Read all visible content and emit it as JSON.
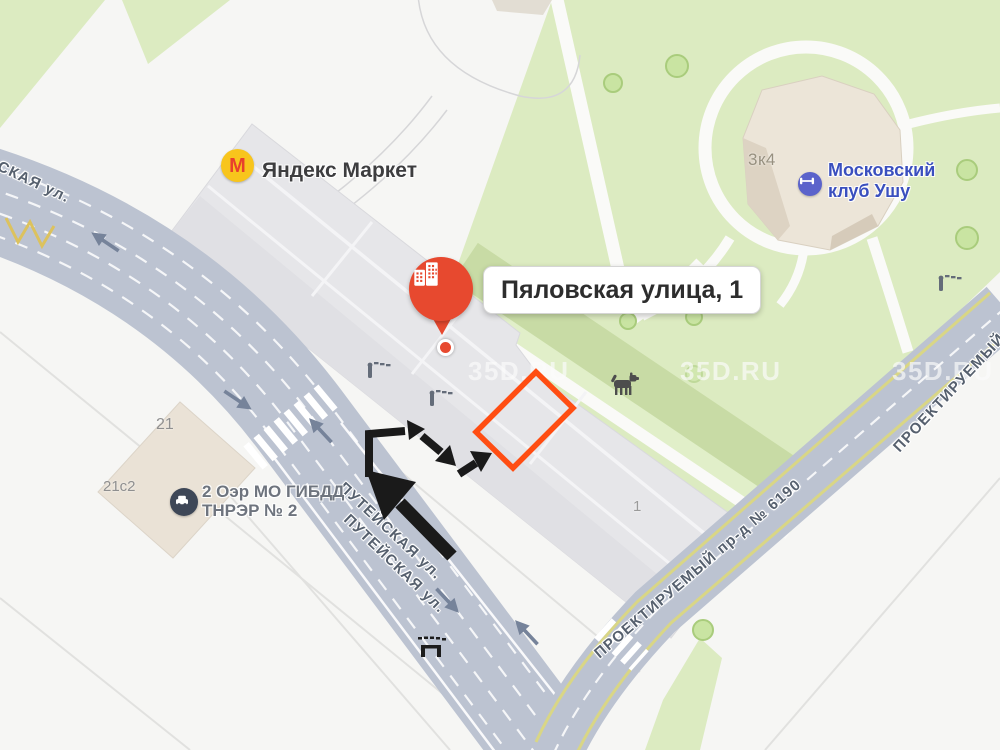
{
  "watermark": {
    "text": "35D.RU"
  },
  "pin": {
    "address_label": "Пяловская улица, 1"
  },
  "pois": {
    "yandex_market": {
      "name": "Яндекс Маркет",
      "icon_letter": "М"
    },
    "ushu_club": {
      "name_line1": "Московский",
      "name_line2": "клуб Ушу"
    },
    "gibdd": {
      "name_line1": "2 Оэр МО ГИБДД",
      "name_line2": "ТНРЭР № 2"
    }
  },
  "streets": {
    "left_partial": "СКАЯ ул.",
    "puteyskaya_1": "ПУТЕЙСКАЯ ул.",
    "puteyskaya_2": "ПУТЕЙСКАЯ ул.",
    "proektiruemy_6190": "ПРОЕКТИРУЕМЫЙ пр-д № 6190",
    "proektiruemy_partial": "ПРОЕКТИРУЕМЫЙ"
  },
  "buildings": {
    "b21": "21",
    "b21s2": "21с2",
    "b1": "1",
    "b3k4": "3к4"
  },
  "colors": {
    "highlight_orange": "#ff4d12",
    "annotation_black": "#1a1a1a",
    "pin_red": "#e7492f",
    "market_yellow": "#f8c51c",
    "market_letter_red": "#e8402c",
    "ushu_blue": "#5b63cb",
    "ushu_text_blue": "#3a4fbe",
    "road_gray": "#bcc3d1",
    "green_area": "#dcebc1"
  }
}
